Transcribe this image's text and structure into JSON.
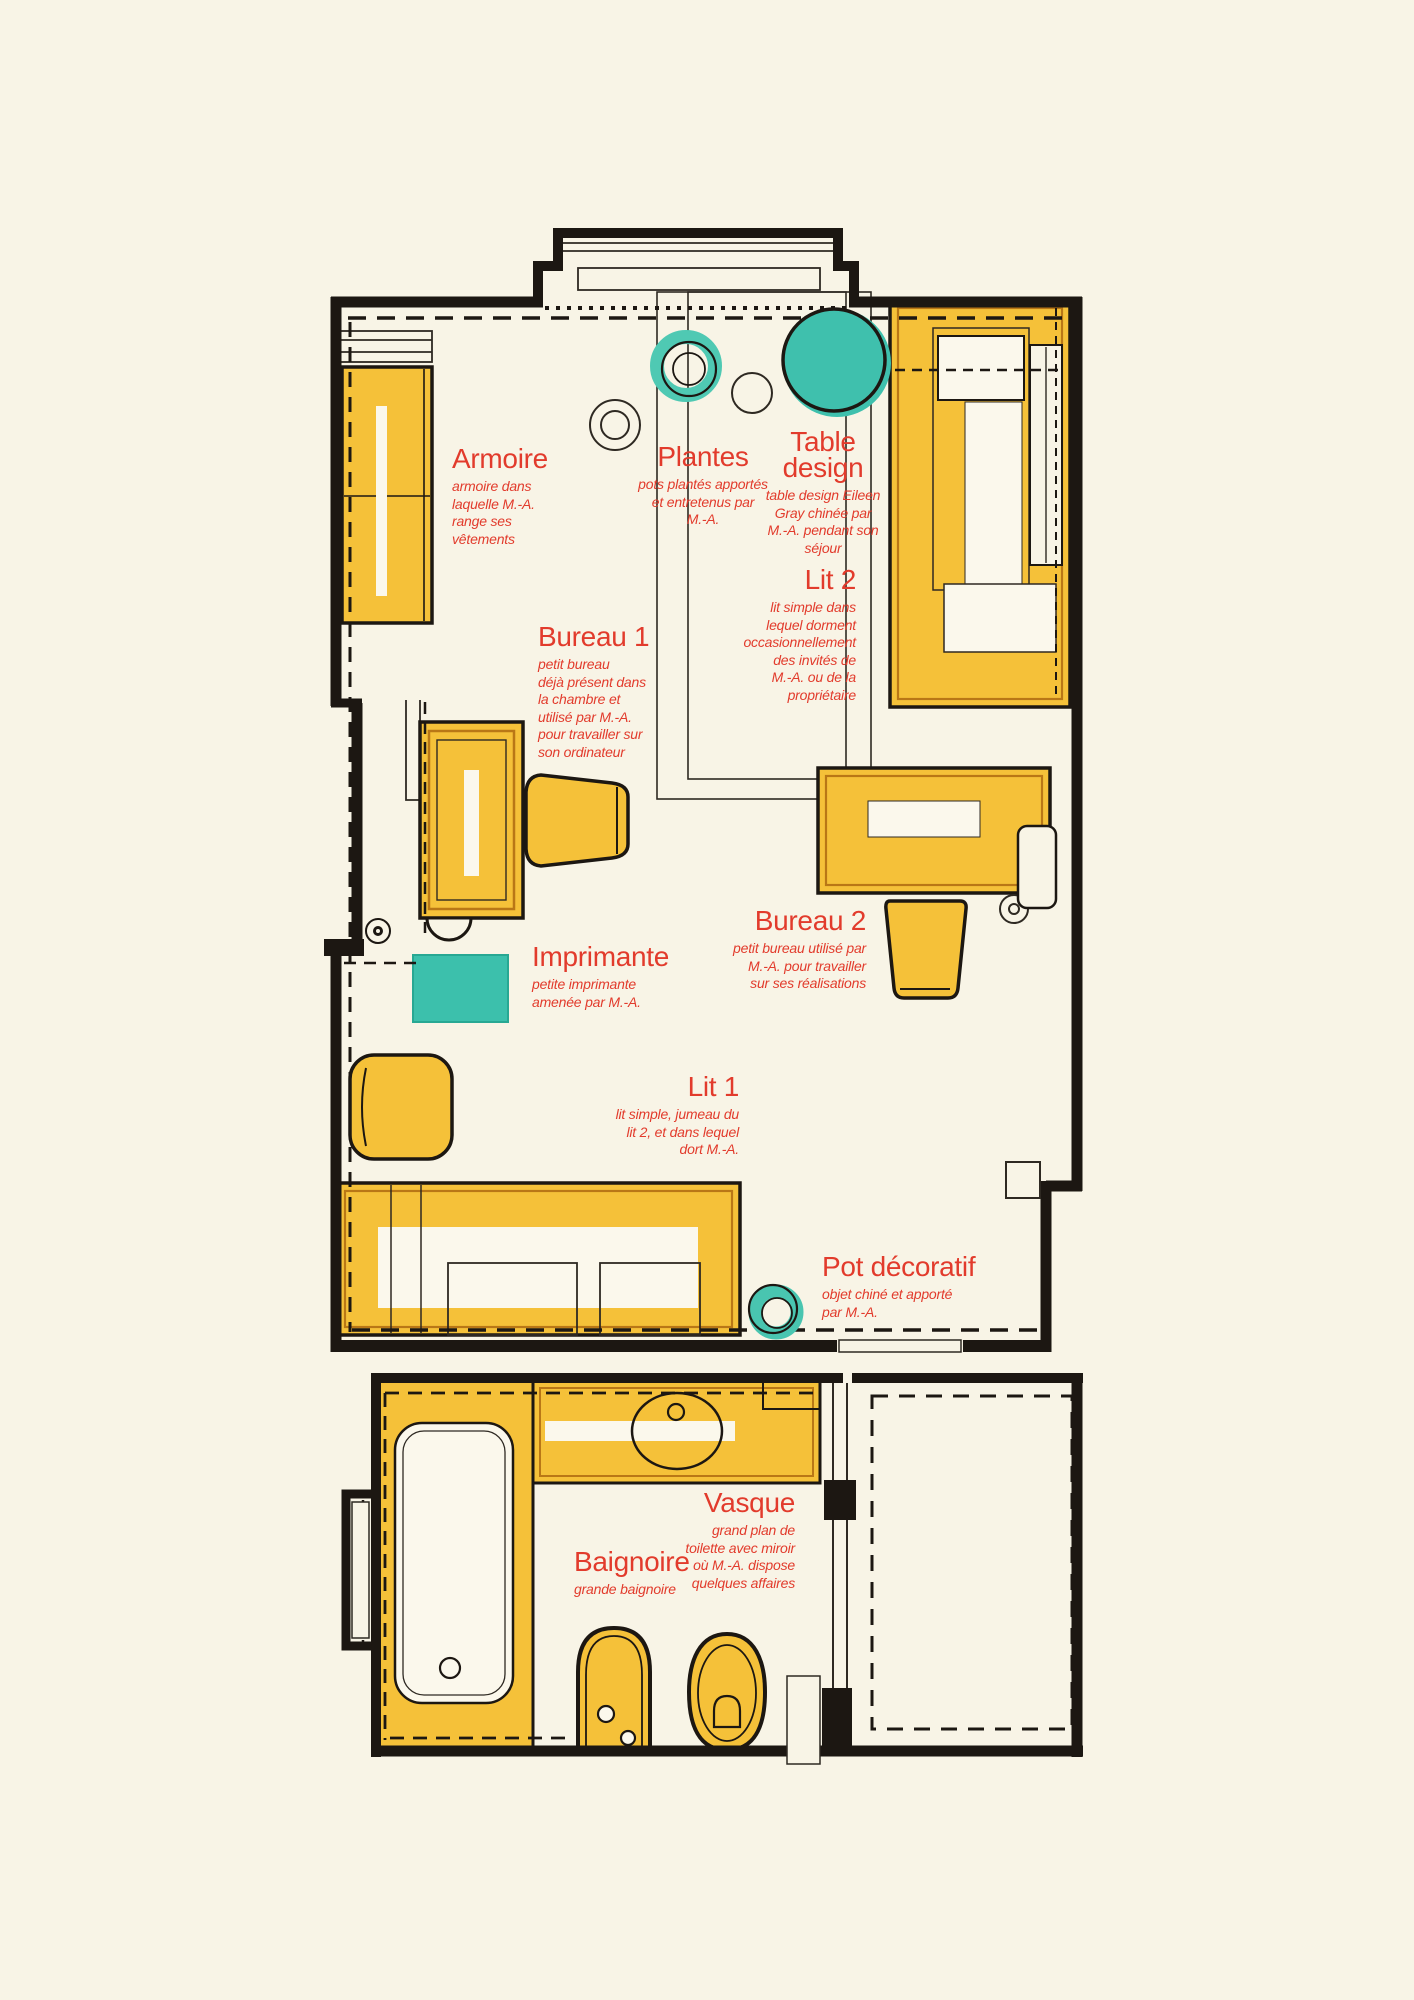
{
  "plan_title": "Plan de chambre et salle de bain (meubles annotés)",
  "colors": {
    "paper": "#f8f4e6",
    "ink": "#1c1712",
    "furniture_yellow": "#f5c139",
    "furniture_border": "#b97716",
    "teal": "#42c2ae",
    "label_red": "#e23b2c"
  },
  "labels": {
    "armoire": {
      "title": "Armoire",
      "desc": "armoire dans\nlaquelle M.-A.\nrange ses\nvêtements"
    },
    "plantes": {
      "title": "Plantes",
      "desc": "pots plantés apportés\net entretenus par\nM.-A."
    },
    "table": {
      "title": "Table\ndesign",
      "desc": "table design Eileen\nGray chinée par\nM.-A. pendant son\nséjour"
    },
    "lit2": {
      "title": "Lit 2",
      "desc": "lit simple dans\nlequel dorment\noccasionnellement\ndes invités de\nM.-A. ou de la\npropriétaire"
    },
    "bureau1": {
      "title": "Bureau 1",
      "desc": "petit bureau\ndéjà présent dans\nla chambre et\nutilisé par M.-A.\npour travailler sur\nson ordinateur"
    },
    "bureau2": {
      "title": "Bureau 2",
      "desc": "petit bureau utilisé par\nM.-A. pour travailler\nsur ses réalisations"
    },
    "imprimante": {
      "title": "Imprimante",
      "desc": "petite imprimante\namenée par M.-A."
    },
    "lit1": {
      "title": "Lit 1",
      "desc": "lit simple, jumeau du\nlit 2, et dans lequel\ndort M.-A."
    },
    "pot": {
      "title": "Pot décoratif",
      "desc": "objet chiné et apporté\npar M.-A."
    },
    "vasque": {
      "title": "Vasque",
      "desc": "grand plan de\ntoilette avec miroir\noù M.-A. dispose\nquelques affaires"
    },
    "baignoire": {
      "title": "Baignoire",
      "desc": "grande baignoire"
    }
  }
}
